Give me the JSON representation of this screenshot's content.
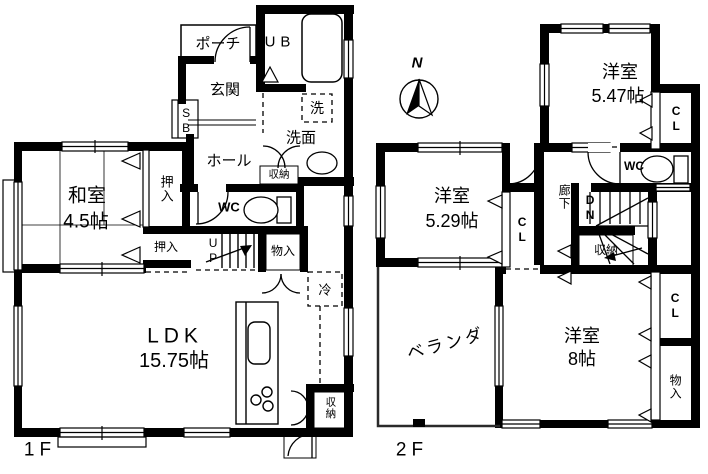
{
  "floor1": {
    "name": "1F",
    "labels": {
      "porch": "ポーチ",
      "ub": "UB",
      "genkan": "玄関",
      "sb": "SB",
      "washer": "洗",
      "senmen": "洗面",
      "hall": "ホール",
      "hall_storage": "収納",
      "wc": "WC",
      "washitsu": "和室",
      "washitsu_size": "4.5帖",
      "oshiire_upper": "押入",
      "oshiire_lower": "押入",
      "up": "UP",
      "monoiri": "物入",
      "fridge": "冷",
      "ldk": "LDK",
      "ldk_size": "15.75帖",
      "ldk_storage": "収納"
    }
  },
  "floor2": {
    "name": "2F",
    "labels": {
      "room547": "洋室",
      "room547_size": "5.47帖",
      "cl_547": "CL",
      "wc": "WC",
      "rouka": "廊下",
      "dn": "DN",
      "storage": "収納",
      "room529": "洋室",
      "room529_size": "5.29帖",
      "cl_529": "CL",
      "veranda": "ベランダ",
      "room8": "洋室",
      "room8_size": "8帖",
      "cl_8": "CL",
      "monoiri": "物入"
    }
  },
  "compass": {
    "north": "N"
  },
  "colors": {
    "wall": "#000000",
    "background": "#ffffff"
  }
}
